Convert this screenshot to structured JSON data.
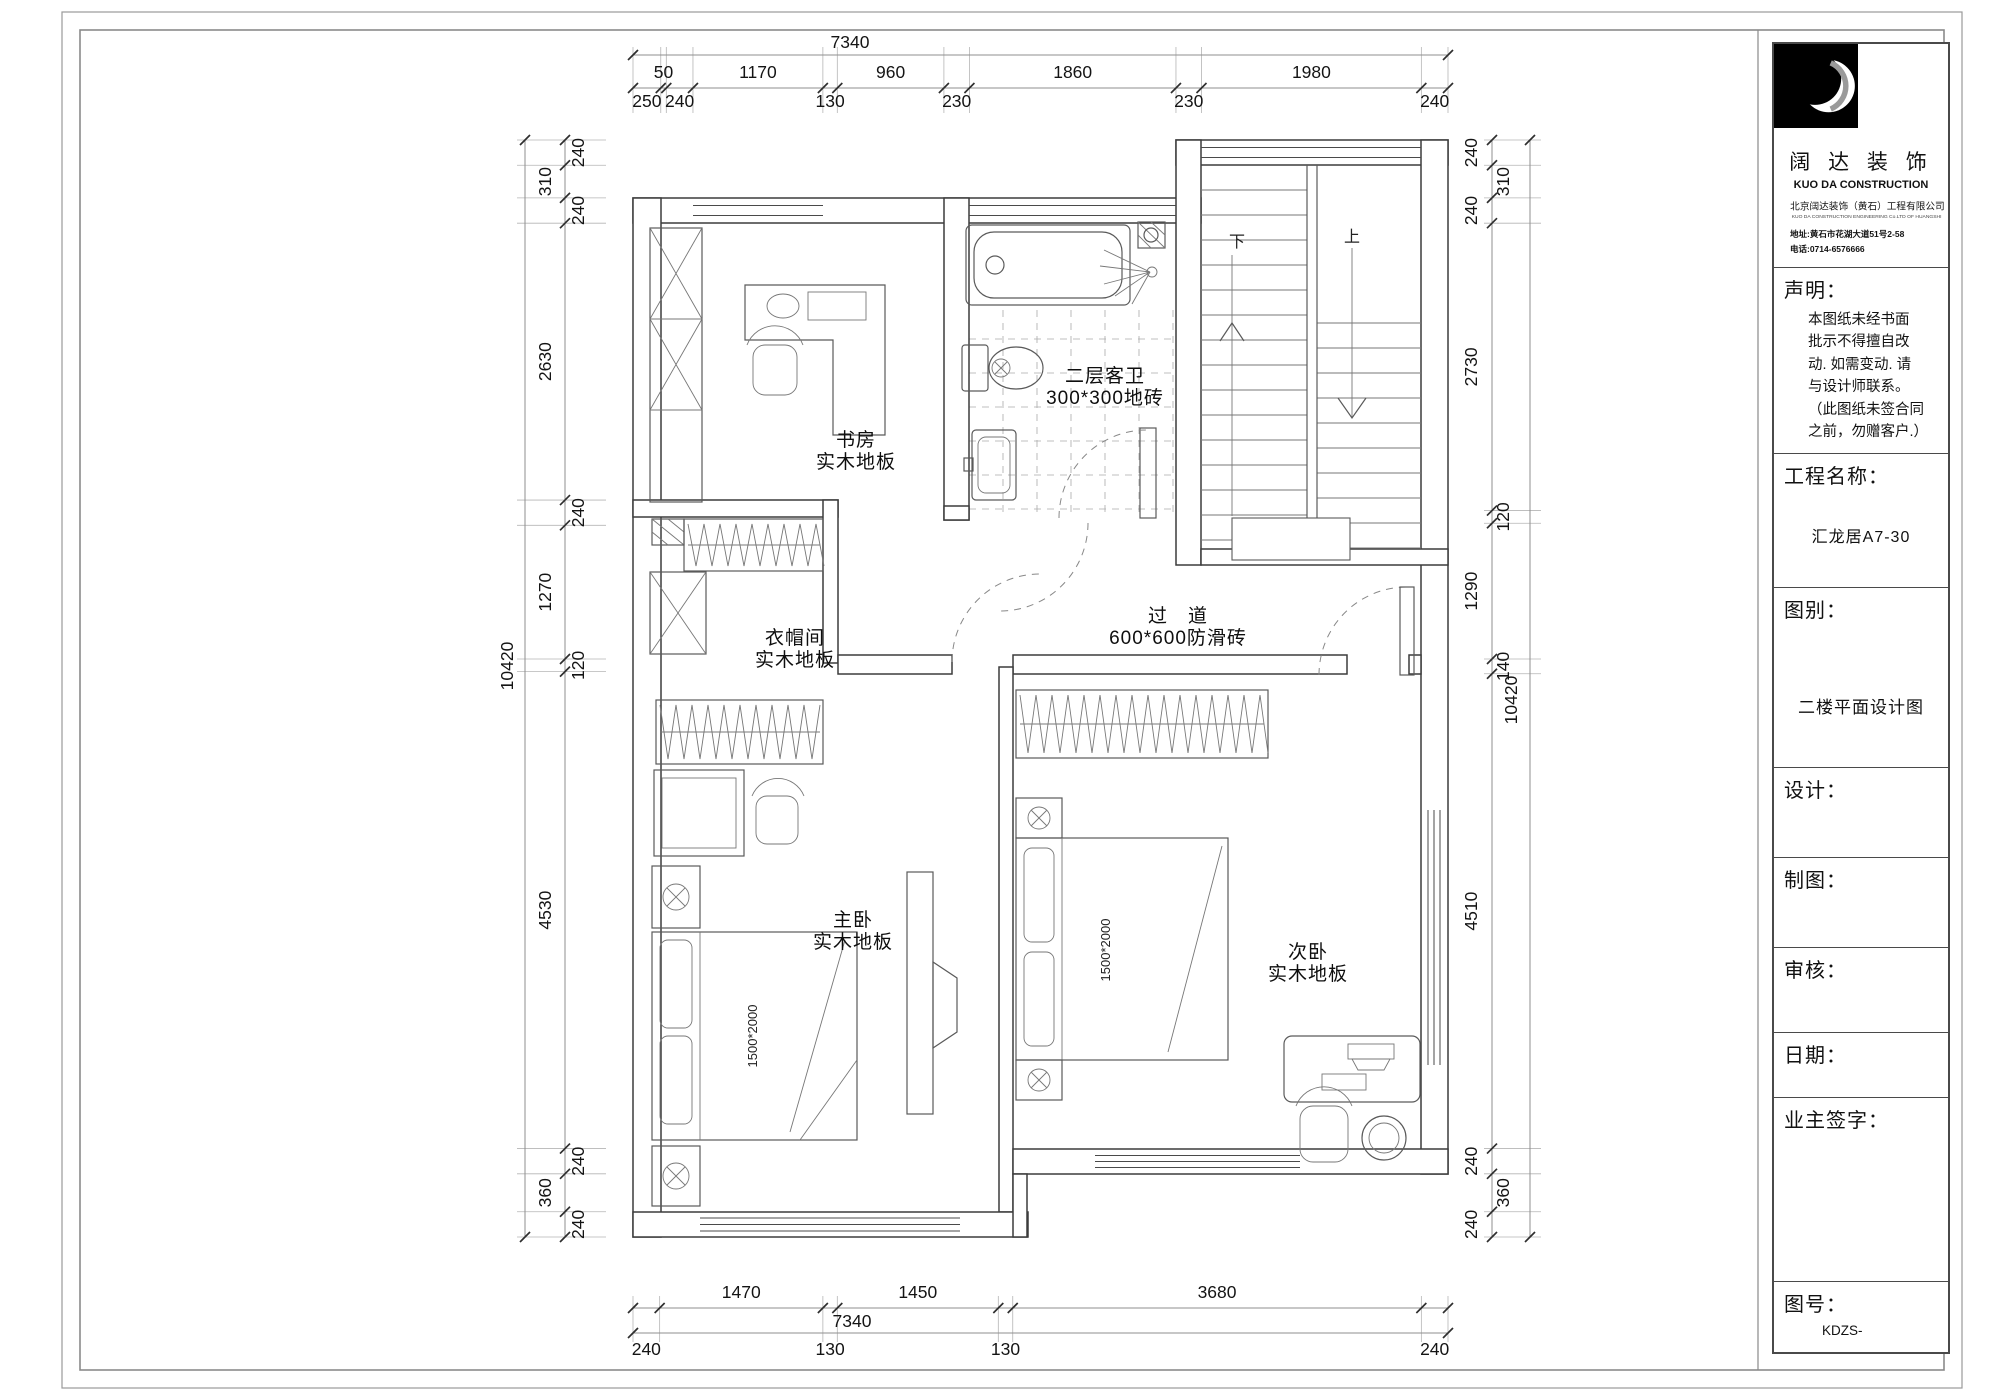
{
  "title_block": {
    "company_cn": "阔 达 装 饰",
    "company_en": "KUO DA CONSTRUCTION",
    "company_full": "北京阔达装饰（黄石）工程有限公司",
    "company_full_en": "KUO DA CONSTRUCTION ENGINEERING Co.LTD OF HUANGSHI",
    "address": "地址:黄石市花湖大道51号2-58",
    "phone": "电话:0714-6576666",
    "statement_label": "声明：",
    "statement_lines": [
      "本图纸未经书面",
      "批示不得擅自改",
      "动. 如需变动. 请",
      "与设计师联系。",
      "（此图纸未签合同",
      "之前，勿赠客户.）"
    ],
    "project_label": "工程名称：",
    "project_value": "汇龙居A7-30",
    "sheet_label": "图别：",
    "sheet_value": "二楼平面设计图",
    "design_label": "设计：",
    "draft_label": "制图：",
    "review_label": "审核：",
    "date_label": "日期：",
    "owner_label": "业主签字：",
    "number_label": "图号：",
    "number_value": "KDZS-"
  },
  "rooms": [
    {
      "id": "study",
      "name": "书房",
      "floor": "实木地板"
    },
    {
      "id": "bath",
      "name": "二层客卫",
      "floor": "300*300地砖"
    },
    {
      "id": "closet",
      "name": "衣帽间",
      "floor": "实木地板"
    },
    {
      "id": "corridor",
      "name": "过　道",
      "floor": "600*600防滑砖"
    },
    {
      "id": "master",
      "name": "主卧",
      "floor": "实木地板"
    },
    {
      "id": "second",
      "name": "次卧",
      "floor": "实木地板"
    }
  ],
  "stairs": {
    "up": "上",
    "down": "下"
  },
  "beds": [
    {
      "size": "1500*2000"
    },
    {
      "size": "1500*2000"
    }
  ],
  "dimensions": {
    "top": {
      "total": "7340",
      "segments": [
        "250",
        "50",
        "240",
        "1170",
        "130",
        "960",
        "230",
        "1860",
        "230",
        "1980",
        "240"
      ]
    },
    "bottom": {
      "total": "7340",
      "segments": [
        "240",
        "1470",
        "130",
        "1450",
        "130",
        "3680",
        "240"
      ]
    },
    "left": {
      "total": "10420",
      "segments": [
        "240",
        "310",
        "240",
        "2630",
        "240",
        "1270",
        "120",
        "4530",
        "240",
        "360",
        "240"
      ]
    },
    "right": {
      "total": "10420",
      "segments": [
        "240",
        "310",
        "240",
        "2730",
        "120",
        "1290",
        "140",
        "4510",
        "240",
        "360",
        "240"
      ]
    }
  }
}
